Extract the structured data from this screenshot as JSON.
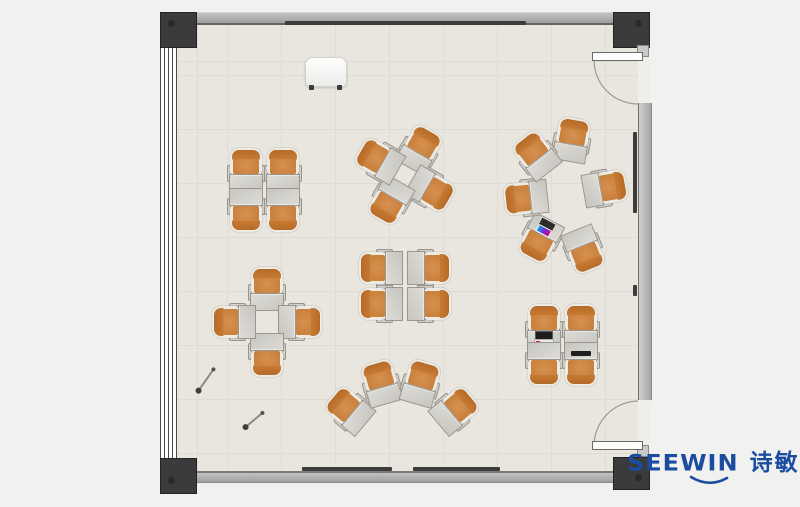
{
  "brand": {
    "wordmark": "SEEWIN",
    "cjk_name": "诗敏",
    "color": "#1a4c9f"
  },
  "floorplan": {
    "floor_color": "#e9e6df",
    "wall_color": "#a9a9a7",
    "column_color": "#3b3b3b",
    "chair_color": "#c87c35",
    "desk_color": "#d4d2cd",
    "laptop_screen_colors": [
      "#e0007f",
      "#6a2ce0",
      "#00b7e0"
    ],
    "clusters": [
      {
        "name": "grid-2x2-top-left"
      },
      {
        "name": "pinwheel-top-middle"
      },
      {
        "name": "circle-of-6-right"
      },
      {
        "name": "face-to-face-2x2-middle"
      },
      {
        "name": "cross-left"
      },
      {
        "name": "fan-of-4-bottom"
      },
      {
        "name": "grid-2x2-bottom-right"
      }
    ],
    "units": [
      {
        "x": 246,
        "y": 170,
        "rot": 0,
        "laptop": null
      },
      {
        "x": 283,
        "y": 170,
        "rot": 0,
        "laptop": null
      },
      {
        "x": 246,
        "y": 210,
        "rot": 180,
        "laptop": null
      },
      {
        "x": 283,
        "y": 210,
        "rot": 180,
        "laptop": null
      },
      {
        "x": 420,
        "y": 149,
        "rot": 30,
        "laptop": null
      },
      {
        "x": 431,
        "y": 190,
        "rot": 120,
        "laptop": null
      },
      {
        "x": 390,
        "y": 201,
        "rot": 210,
        "laptop": null
      },
      {
        "x": 379,
        "y": 160,
        "rot": 300,
        "laptop": null
      },
      {
        "x": 572,
        "y": 140,
        "rot": 10,
        "laptop": null
      },
      {
        "x": 605,
        "y": 188,
        "rot": 80,
        "laptop": null
      },
      {
        "x": 584,
        "y": 250,
        "rot": 158,
        "laptop": null
      },
      {
        "x": 540,
        "y": 239,
        "rot": 208,
        "laptop": "color"
      },
      {
        "x": 526,
        "y": 198,
        "rot": 264,
        "laptop": null
      },
      {
        "x": 536,
        "y": 155,
        "rot": 322,
        "laptop": null
      },
      {
        "x": 381,
        "y": 268,
        "rot": 270,
        "laptop": null
      },
      {
        "x": 381,
        "y": 304,
        "rot": 270,
        "laptop": null
      },
      {
        "x": 429,
        "y": 268,
        "rot": 90,
        "laptop": null
      },
      {
        "x": 429,
        "y": 304,
        "rot": 90,
        "laptop": null
      },
      {
        "x": 267,
        "y": 289,
        "rot": 0,
        "laptop": null
      },
      {
        "x": 300,
        "y": 322,
        "rot": 90,
        "laptop": null
      },
      {
        "x": 267,
        "y": 355,
        "rot": 180,
        "laptop": null
      },
      {
        "x": 234,
        "y": 322,
        "rot": 270,
        "laptop": null
      },
      {
        "x": 349,
        "y": 410,
        "rot": -50,
        "laptop": null
      },
      {
        "x": 381,
        "y": 383,
        "rot": -16,
        "laptop": null
      },
      {
        "x": 421,
        "y": 383,
        "rot": 16,
        "laptop": null
      },
      {
        "x": 455,
        "y": 410,
        "rot": 50,
        "laptop": null
      },
      {
        "x": 544,
        "y": 326,
        "rot": 0,
        "laptop": "dark"
      },
      {
        "x": 581,
        "y": 326,
        "rot": 0,
        "laptop": null
      },
      {
        "x": 544,
        "y": 364,
        "rot": 180,
        "laptop": null
      },
      {
        "x": 581,
        "y": 364,
        "rot": 180,
        "laptop": "closed"
      }
    ],
    "pins": [
      {
        "x": 206,
        "y": 380,
        "len": 26,
        "rot": -55
      },
      {
        "x": 254,
        "y": 420,
        "len": 22,
        "rot": -40
      }
    ]
  }
}
